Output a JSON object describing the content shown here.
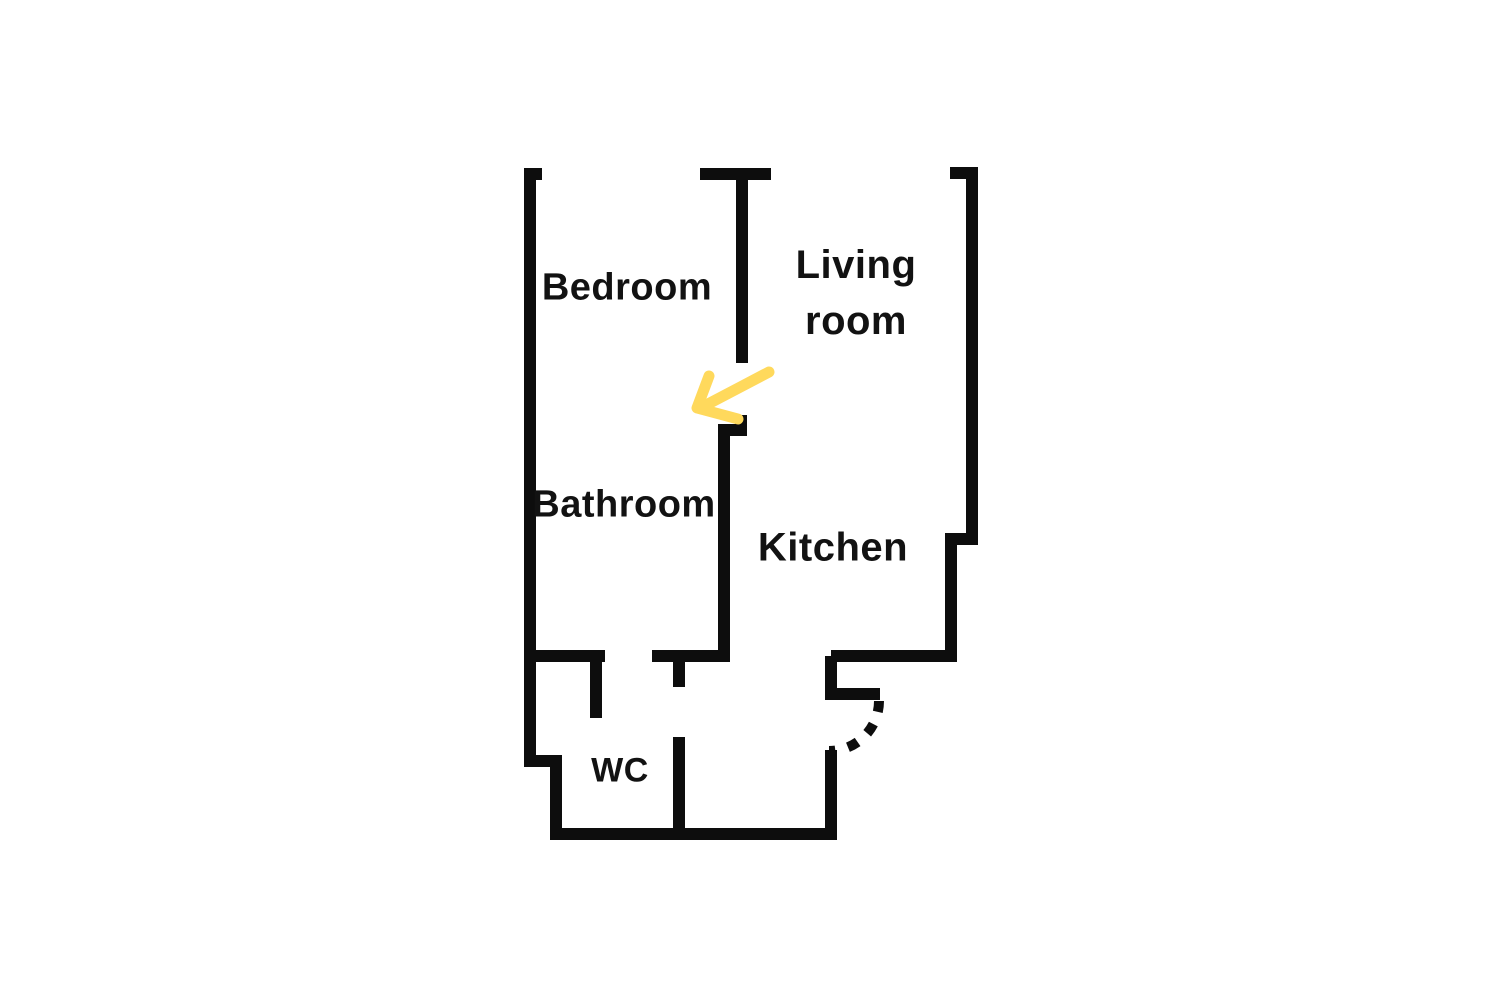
{
  "page": {
    "background": "#ffffff",
    "type": "apartment floor plan"
  },
  "floorplan": {
    "wall_color": "#0d0d0d",
    "text_color": "#121212",
    "wall_thickness": 12,
    "rooms": {
      "bedroom": {
        "label": "Bedroom"
      },
      "living": {
        "label_line1": "Living",
        "label_line2": "room"
      },
      "bathroom": {
        "label": "Bathroom"
      },
      "kitchen": {
        "label": "Kitchen"
      },
      "wc": {
        "label": "WC"
      }
    },
    "walls": [
      {
        "id": "outer-left-and-bottom",
        "d": "M 542 174 L 530 174 L 530 761 L 556 761 L 556 834 L 831 834 L 831 750"
      },
      {
        "id": "kitchen-door-jamb",
        "d": "M 831 656 L 831 694 L 880 694"
      },
      {
        "id": "outer-right",
        "d": "M 831 656 L 951 656 L 951 539 L 972 539 L 972 173 L 950 173"
      },
      {
        "id": "bedroom-living-divider",
        "d": "M 700 174 L 771 174 M 742 174 L 742 363"
      },
      {
        "id": "bathroom-kitchen-wall",
        "d": "M 741 415 L 741 430 L 724 430 L 724 656"
      },
      {
        "id": "bathroom-south-wall",
        "d": "M 524 656 L 605 656 M 596 656 L 596 718"
      },
      {
        "id": "hall-south-wall",
        "d": "M 652 656 L 730 656"
      },
      {
        "id": "wc-wall",
        "d": "M 679 656 L 679 687 M 679 737 L 679 834"
      }
    ],
    "door_arc": {
      "d": "M 879 701 A 50 50 0 0 1 829 751",
      "dash": "11 13",
      "width": 10
    },
    "arrow": {
      "color": "#FFD95C",
      "width": 11,
      "shaft_d": "M 769 372 L 708 404",
      "head_d": "M 709 376 L 697 408 L 738 419"
    }
  }
}
